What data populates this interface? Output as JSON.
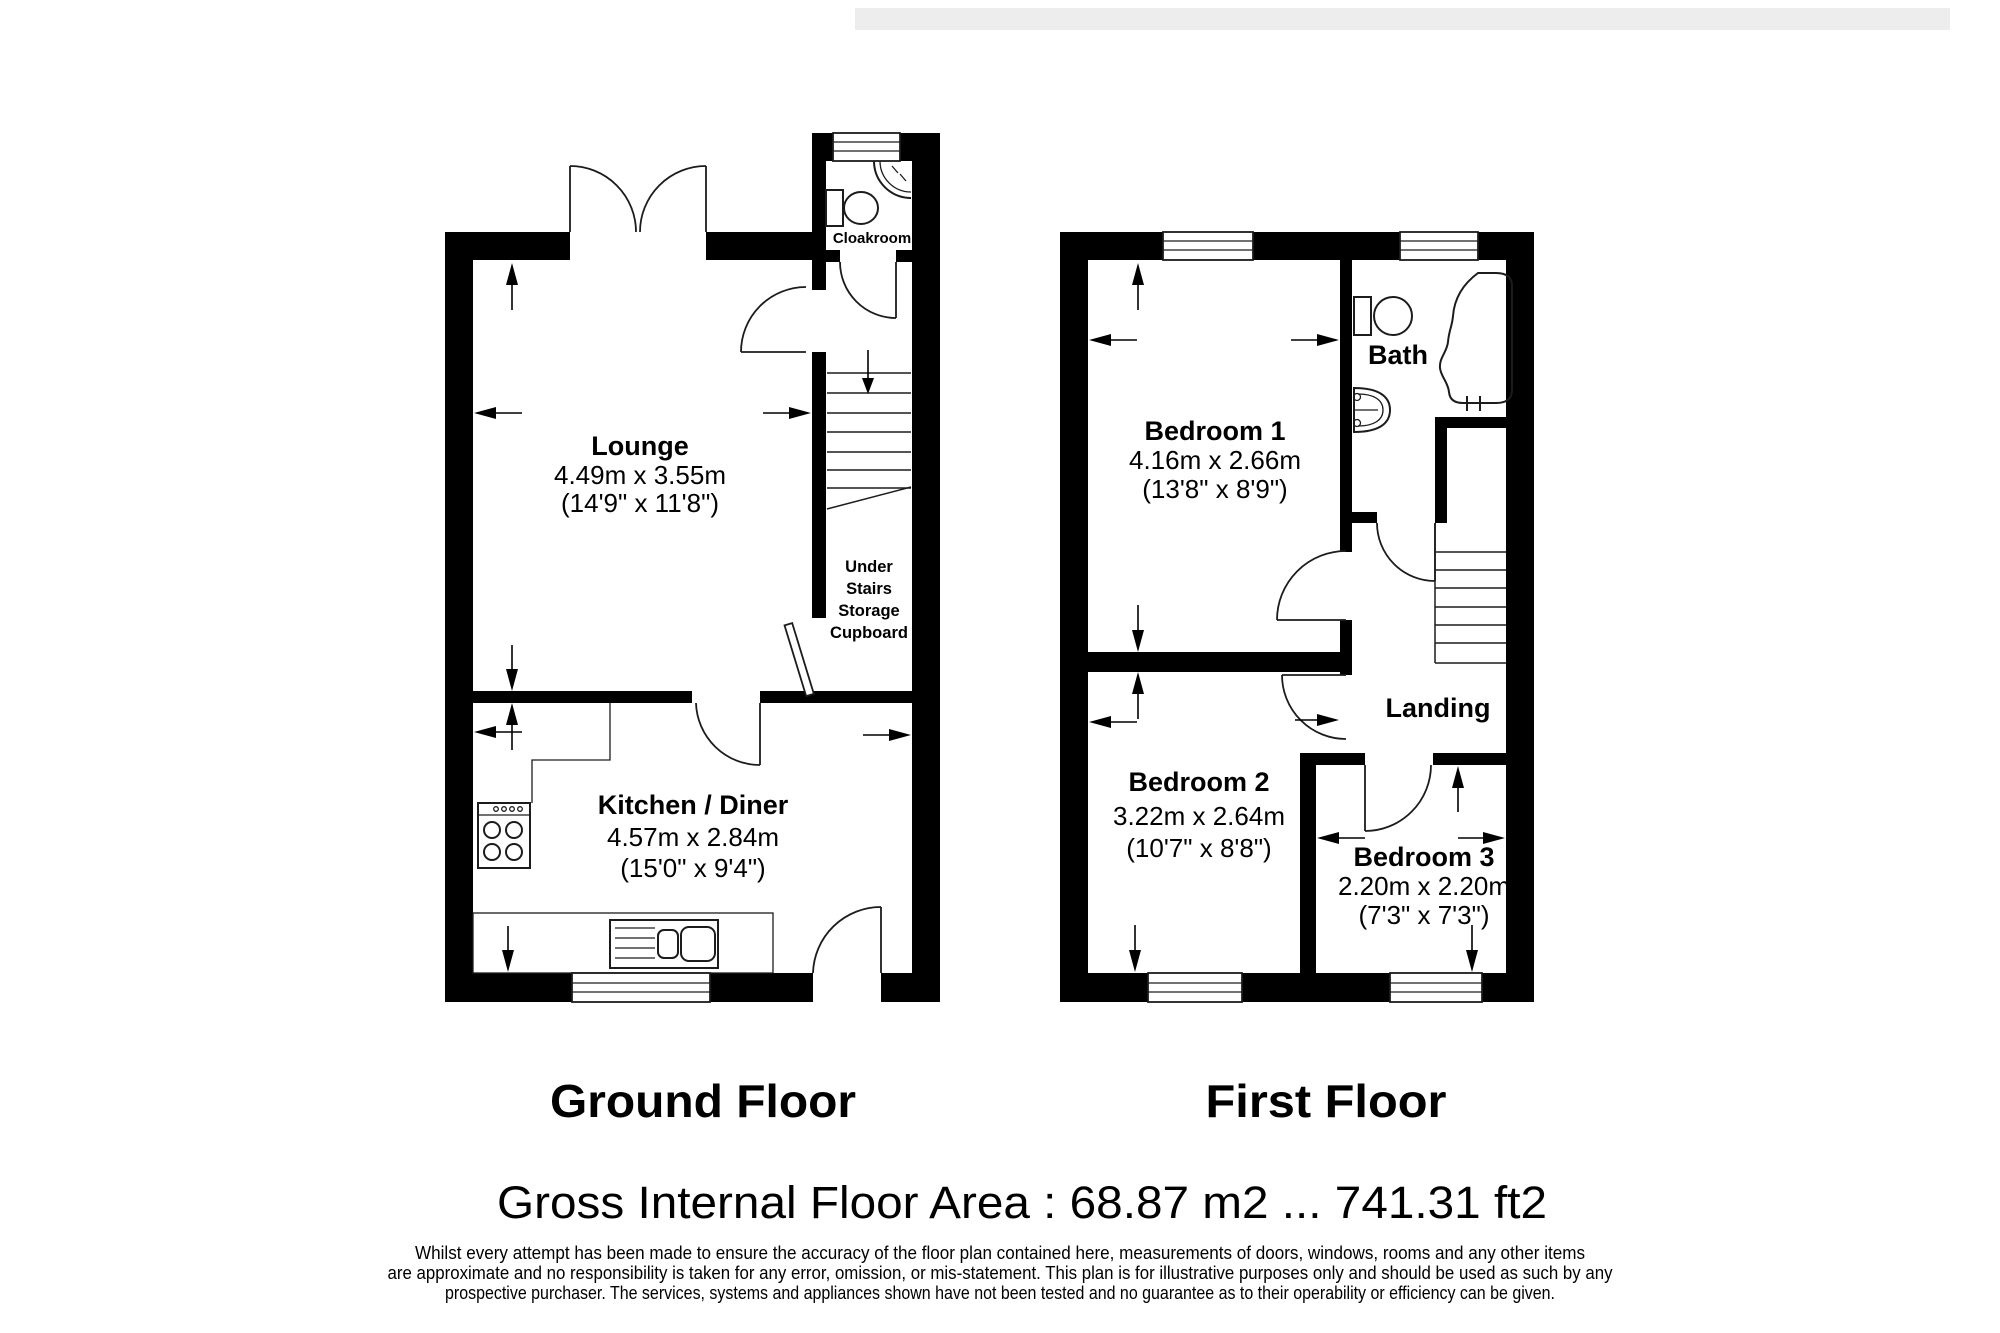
{
  "ground": {
    "label": "Ground Floor",
    "lounge": {
      "name": "Lounge",
      "metric": "4.49m x 3.55m",
      "imperial": "(14'9\" x 11'8\")"
    },
    "kitchen": {
      "name": "Kitchen / Diner",
      "metric": "4.57m x 2.84m",
      "imperial": "(15'0\" x 9'4\")"
    },
    "cloakroom": {
      "name": "Cloakroom"
    },
    "cupboard": {
      "line1": "Under",
      "line2": "Stairs",
      "line3": "Storage",
      "line4": "Cupboard"
    }
  },
  "first": {
    "label": "First Floor",
    "bedroom1": {
      "name": "Bedroom 1",
      "metric": "4.16m x 2.66m",
      "imperial": "(13'8\" x 8'9\")"
    },
    "bedroom2": {
      "name": "Bedroom 2",
      "metric": "3.22m x 2.64m",
      "imperial": "(10'7\" x 8'8\")"
    },
    "bedroom3": {
      "name": "Bedroom 3",
      "metric": "2.20m x 2.20m",
      "imperial": "(7'3\" x 7'3\")"
    },
    "bath": {
      "name": "Bath"
    },
    "landing": {
      "name": "Landing"
    }
  },
  "footer": {
    "gross_area": "Gross Internal Floor Area : 68.87 m2 ... 741.31 ft2",
    "disclaimer1": "Whilst every attempt has been made to ensure the accuracy of the floor plan contained here, measurements of doors, windows, rooms and any other items",
    "disclaimer2": "are approximate and no responsibility is taken for any error, omission, or mis-statement. This plan is for illustrative purposes only and should be used as such by any",
    "disclaimer3": "prospective purchaser. The services, systems and appliances shown have not been tested and no guarantee as to their operability or efficiency can be given."
  },
  "colors": {
    "wall": "#000000",
    "fixture_line": "#1c1c1c",
    "background": "#ffffff",
    "top_strip": "#ededed"
  }
}
